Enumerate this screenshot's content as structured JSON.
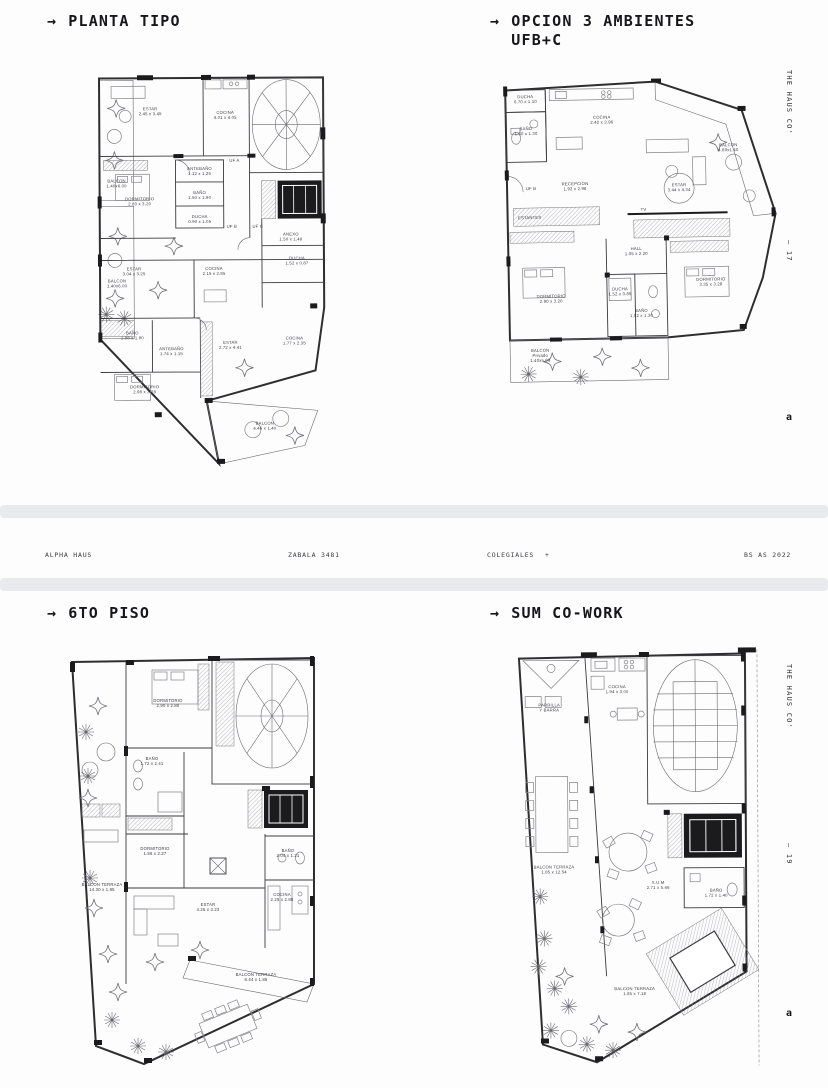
{
  "page": {
    "footer": {
      "project": "ALPHA HAUS",
      "address": "ZABALA 3481",
      "neighborhood": "COLEGIALES",
      "plus": "+",
      "city_year": "BS AS 2022"
    },
    "side_top": {
      "brand": "THE HAUS CO'",
      "page_number": "— 17",
      "logo": "a"
    },
    "side_bottom": {
      "brand": "THE HAUS CO'",
      "page_number": "— 19",
      "logo": "a"
    },
    "colors": {
      "ink": "#2e2e30",
      "sheet_edge": "#e8eaed",
      "wall_black": "#1b1b1d"
    }
  },
  "plans": [
    {
      "arrow": "→",
      "title_line1": "PLANTA TIPO",
      "title_line2": "",
      "rooms": [
        {
          "lines": [
            "BALCON",
            "1.40x6.00"
          ],
          "x": 63,
          "y": 114
        },
        {
          "lines": [
            "BALCON",
            "1.40x6.00"
          ],
          "x": 63,
          "y": 214
        },
        {
          "lines": [
            "ESTAR",
            "2.45 x 3.45"
          ],
          "x": 97,
          "y": 42
        },
        {
          "lines": [
            "COCINA",
            "4.01 x 4.05"
          ],
          "x": 172,
          "y": 46
        },
        {
          "lines": [
            "UF A"
          ],
          "x": 181,
          "y": 94
        },
        {
          "lines": [
            "ANTEBAÑO",
            "1.12 x 1.25"
          ],
          "x": 146,
          "y": 102
        },
        {
          "lines": [
            "BAÑO",
            "1.50 x 1.90"
          ],
          "x": 146,
          "y": 126
        },
        {
          "lines": [
            "DUCHA",
            "0.90 x 1.05"
          ],
          "x": 146,
          "y": 150
        },
        {
          "lines": [
            "DORMITORIO",
            "2.80 x 3.20"
          ],
          "x": 86,
          "y": 132
        },
        {
          "lines": [
            "UF B"
          ],
          "x": 178,
          "y": 160
        },
        {
          "lines": [
            "UF C"
          ],
          "x": 204,
          "y": 160
        },
        {
          "lines": [
            "ESTAR",
            "3.04 x 3.25"
          ],
          "x": 80,
          "y": 202
        },
        {
          "lines": [
            "COCINA",
            "2.15 x 2.85"
          ],
          "x": 160,
          "y": 202
        },
        {
          "lines": [
            "ANEXO",
            "1.50 x 1.48"
          ],
          "x": 237,
          "y": 168
        },
        {
          "lines": [
            "DUCHA",
            "1.52 x 0.87"
          ],
          "x": 243,
          "y": 192
        },
        {
          "lines": [
            "BAÑO",
            "1.98 x 1.90"
          ],
          "x": 78,
          "y": 266
        },
        {
          "lines": [
            "ANTEBAÑO",
            "1.74 x 1.15"
          ],
          "x": 117,
          "y": 282
        },
        {
          "lines": [
            "ESTAR",
            "2.72 x 4.41"
          ],
          "x": 176,
          "y": 276
        },
        {
          "lines": [
            "COCINA",
            "1.77 x 2.35"
          ],
          "x": 240,
          "y": 272
        },
        {
          "lines": [
            "DORMITORIO",
            "2.98 x 3.28"
          ],
          "x": 90,
          "y": 320
        },
        {
          "lines": [
            "BALCON",
            "4.46 x 1.40"
          ],
          "x": 210,
          "y": 357
        }
      ]
    },
    {
      "arrow": "→",
      "title_line1": "OPCION 3 AMBIENTES",
      "title_line2": "UFB+C",
      "rooms": [
        {
          "lines": [
            "DUCHA",
            "0.70 x 1.10"
          ],
          "x": 40,
          "y": 18
        },
        {
          "lines": [
            "BAÑO",
            "1.60 x 1.30"
          ],
          "x": 40,
          "y": 50
        },
        {
          "lines": [
            "COCINA",
            "2.42 x 3.96"
          ],
          "x": 116,
          "y": 40
        },
        {
          "lines": [
            "BALCON",
            "4.80x1.40"
          ],
          "x": 242,
          "y": 70
        },
        {
          "lines": [
            "UF B"
          ],
          "x": 44,
          "y": 110
        },
        {
          "lines": [
            "RECEPCION",
            "1.92 x 2.96"
          ],
          "x": 88,
          "y": 106
        },
        {
          "lines": [
            "ESTAR",
            "3.44 x 4.34"
          ],
          "x": 192,
          "y": 109
        },
        {
          "lines": [
            "ESTANTES"
          ],
          "x": 42,
          "y": 139
        },
        {
          "lines": [
            "TV"
          ],
          "x": 156,
          "y": 133
        },
        {
          "lines": [
            "HALL",
            "1.05 x 2.20"
          ],
          "x": 148,
          "y": 172
        },
        {
          "lines": [
            "DORMITORIO",
            "2.90 x 3.20"
          ],
          "x": 62,
          "y": 218
        },
        {
          "lines": [
            "DUCHA",
            "1.52 x 0.85"
          ],
          "x": 131,
          "y": 212
        },
        {
          "lines": [
            "BAÑO",
            "1.52 x 1.30"
          ],
          "x": 152,
          "y": 234
        },
        {
          "lines": [
            "DORMITORIO",
            "3.35 x 3.28"
          ],
          "x": 222,
          "y": 204
        },
        {
          "lines": [
            "BALCON",
            "Privado",
            "1.40x5.09"
          ],
          "x": 50,
          "y": 272
        }
      ]
    },
    {
      "arrow": "→",
      "title_line1": "6TO PISO",
      "title_line2": "",
      "rooms": [
        {
          "lines": [
            "DORMITORIO",
            "2.90 x 2.80"
          ],
          "x": 108,
          "y": 54
        },
        {
          "lines": [
            "BAÑO",
            "1.72 x 2.41"
          ],
          "x": 92,
          "y": 112
        },
        {
          "lines": [
            "DORMITORIO",
            "1.86 x 2.27"
          ],
          "x": 95,
          "y": 202
        },
        {
          "lines": [
            "BALCON TERRAZA",
            "14.30 x 1.85"
          ],
          "x": 42,
          "y": 238
        },
        {
          "lines": [
            "ESTAR",
            "4.25 x 3.23"
          ],
          "x": 148,
          "y": 258
        },
        {
          "lines": [
            "COCINA",
            "2.25 x 2.88"
          ],
          "x": 222,
          "y": 248
        },
        {
          "lines": [
            "BAÑO",
            "2.04 x 1.21"
          ],
          "x": 228,
          "y": 204
        },
        {
          "lines": [
            "BALCON TERRAZA",
            "8.44 x 1.85"
          ],
          "x": 196,
          "y": 328
        }
      ]
    },
    {
      "arrow": "→",
      "title_line1": "SUM CO-WORK",
      "title_line2": "",
      "rooms": [
        {
          "lines": [
            "PARRILLA",
            "Y BARRA"
          ],
          "x": 44,
          "y": 60
        },
        {
          "lines": [
            "COCINA",
            "1.94 x 3.00"
          ],
          "x": 112,
          "y": 42
        },
        {
          "lines": [
            "BALCON TERRAZA",
            "1.85 x 12.54"
          ],
          "x": 48,
          "y": 222
        },
        {
          "lines": [
            "S.U.M",
            "2.71 x 5.46"
          ],
          "x": 152,
          "y": 238
        },
        {
          "lines": [
            "BAÑO",
            "1.72 x 1.40"
          ],
          "x": 210,
          "y": 246
        },
        {
          "lines": [
            "BALCON TERRAZA",
            "1.85 x 7.18"
          ],
          "x": 128,
          "y": 344
        }
      ]
    }
  ]
}
